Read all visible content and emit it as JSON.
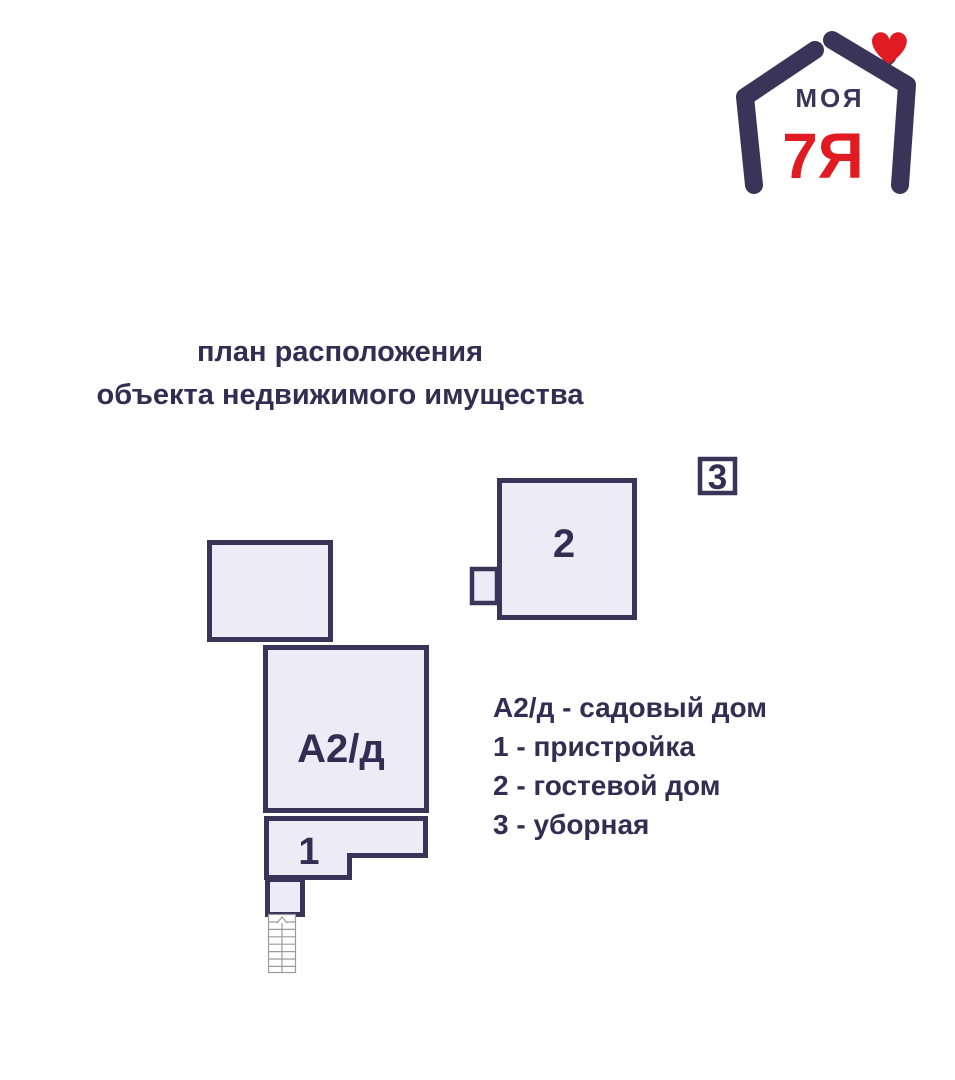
{
  "colors": {
    "navy": "#3b3459",
    "ink": "#332d52",
    "fill": "#edebf6",
    "red": "#e01b22",
    "stairs": "#9b9b9b",
    "bg": "#ffffff"
  },
  "logo": {
    "word_top": "МОЯ",
    "word_bottom": "7Я"
  },
  "title": {
    "line1": "план расположения",
    "line2": "объекта недвижимого имущества"
  },
  "plan": {
    "labels": {
      "main_house": "А2/д",
      "annex": "1",
      "guest_house": "2",
      "toilet": "3"
    }
  },
  "legend": {
    "items": [
      "А2/д - садовый дом",
      "1 - пристройка",
      "2 - гостевой дом",
      "3 - уборная"
    ]
  }
}
